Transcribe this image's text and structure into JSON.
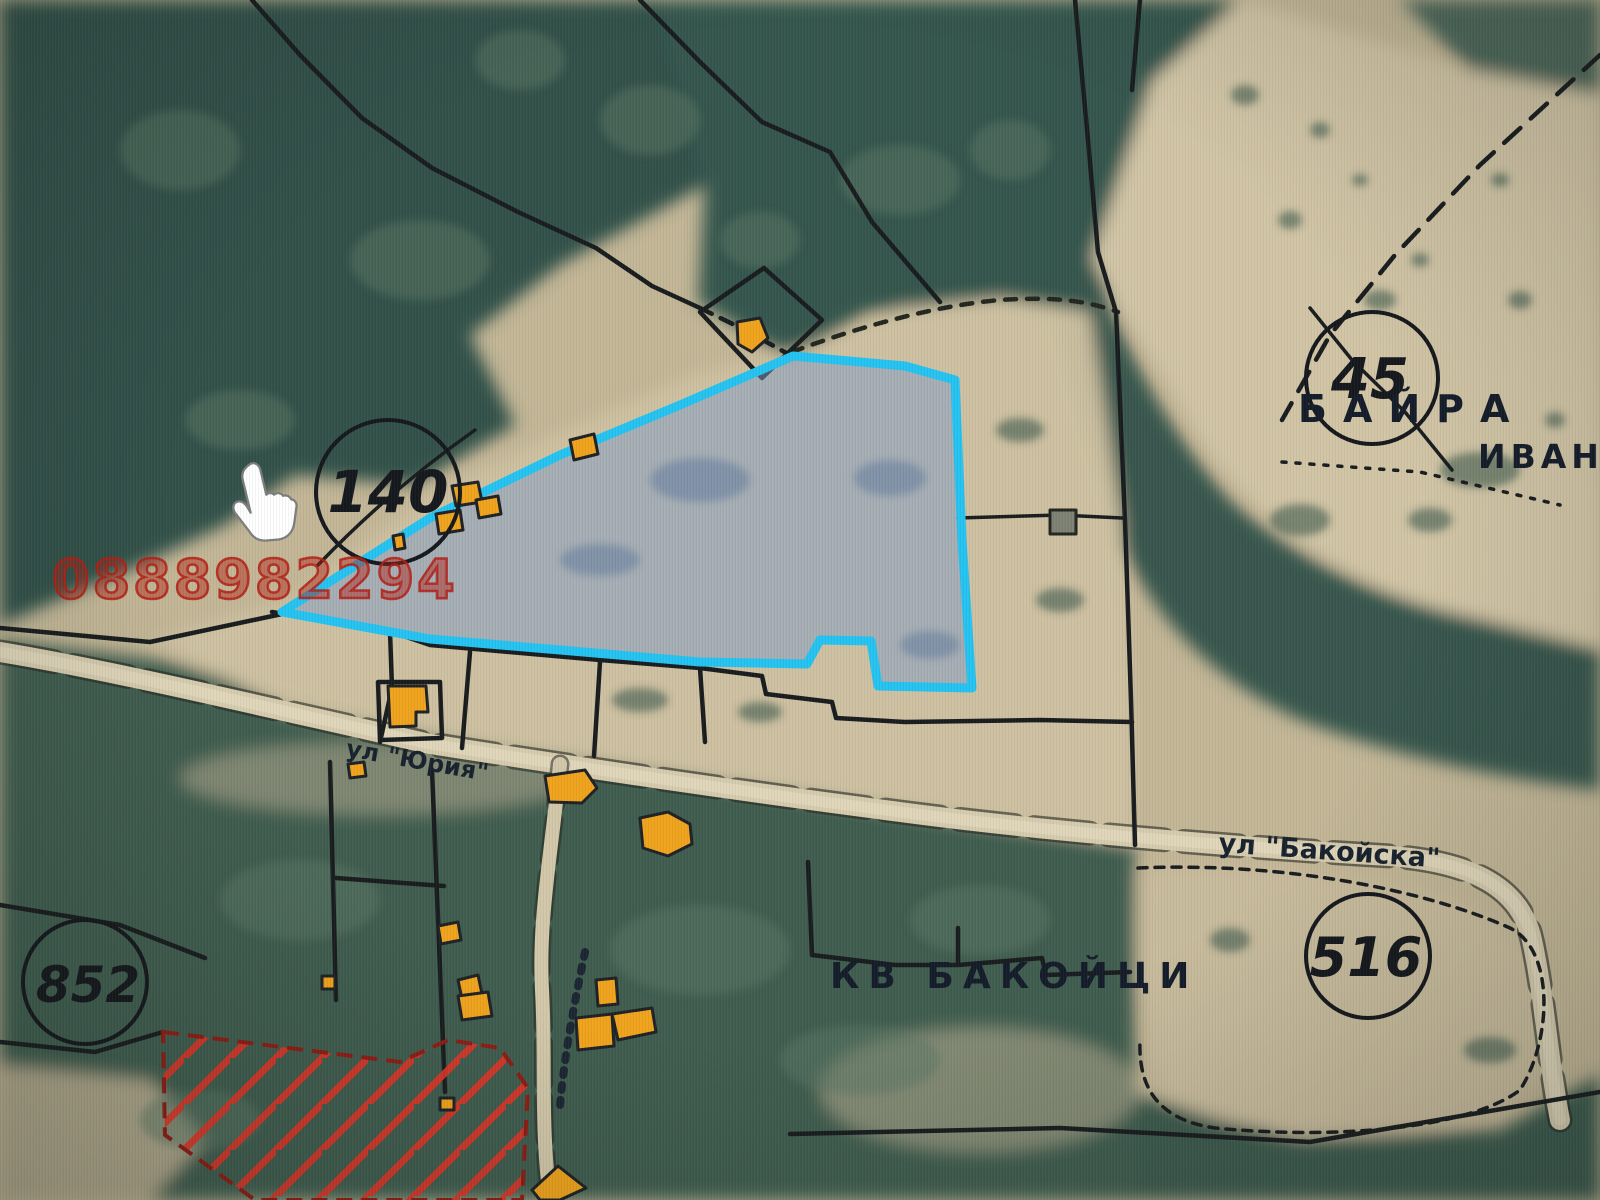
{
  "map": {
    "kind": "cadastral-satellite-map",
    "watermark": "0888982294",
    "place_labels": {
      "baira": "БАЙРА",
      "ivan_partial": "ИВАН",
      "kvartal": "КВ БАКОЙЦИ"
    },
    "street_labels": {
      "bakoyska": "ул \"Бакойска\"",
      "yuria": "ул \"Юрия\""
    },
    "parcel_numbers": [
      {
        "value": "45"
      },
      {
        "value": "140"
      },
      {
        "value": "516"
      },
      {
        "value": "852"
      }
    ],
    "colors": {
      "highlight_outline": "#25c3f2",
      "highlight_fill": "#7d9cc8",
      "building_orange": "#f0a31c",
      "hatch_red": "#e03426",
      "boundary_black": "#191c1e",
      "watermark_red": "#b32015"
    },
    "cursor": "hand-pointer"
  }
}
